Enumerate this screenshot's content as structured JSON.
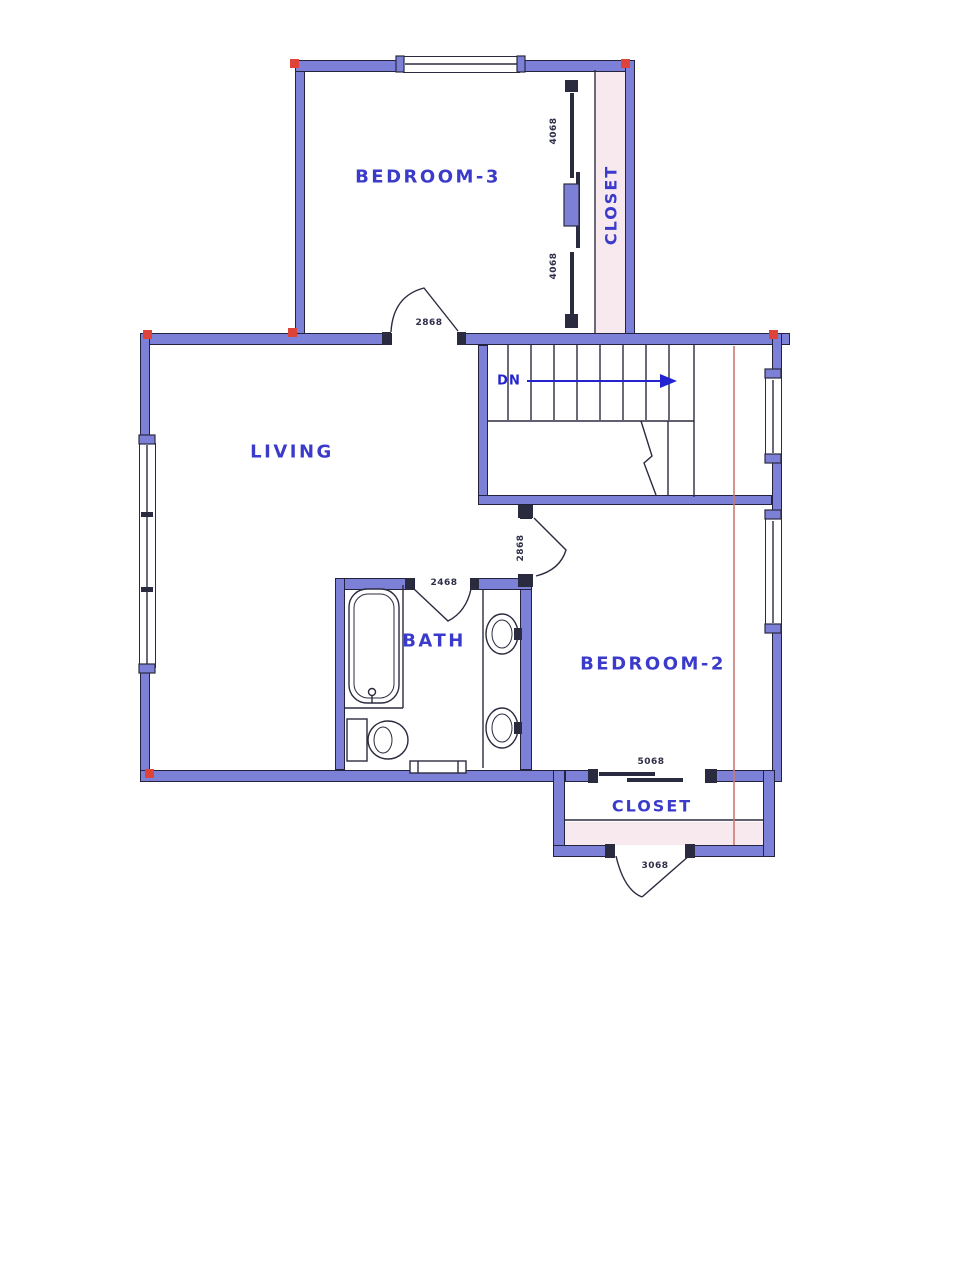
{
  "title": "Upper floor plan",
  "colors": {
    "wall": "#7c80d6",
    "wall_edge": "#23233f",
    "label": "#3b3bcb",
    "dim": "#2e2e4a",
    "closet_fill": "#f7e9ee",
    "red_marker": "#de4339",
    "ref_line": "#cb7a72",
    "line": "#2b2b3f",
    "arrow": "#2323cf"
  },
  "rooms": {
    "bedroom3": {
      "label": "BEDROOM-3"
    },
    "closet3": {
      "label": "CLOSET"
    },
    "living": {
      "label": "LIVING"
    },
    "bath": {
      "label": "BATH"
    },
    "bedroom2": {
      "label": "BEDROOM-2"
    },
    "closet2": {
      "label": "CLOSET"
    }
  },
  "stairs": {
    "direction_label": "DN"
  },
  "dimensions": {
    "closet3_door_upper": "4068",
    "closet3_door_lower": "4068",
    "bedroom3_door": "2868",
    "bath_door": "2468",
    "bedroom2_door": "2868",
    "closet2_slider": "5068",
    "closet2_door": "3068"
  }
}
